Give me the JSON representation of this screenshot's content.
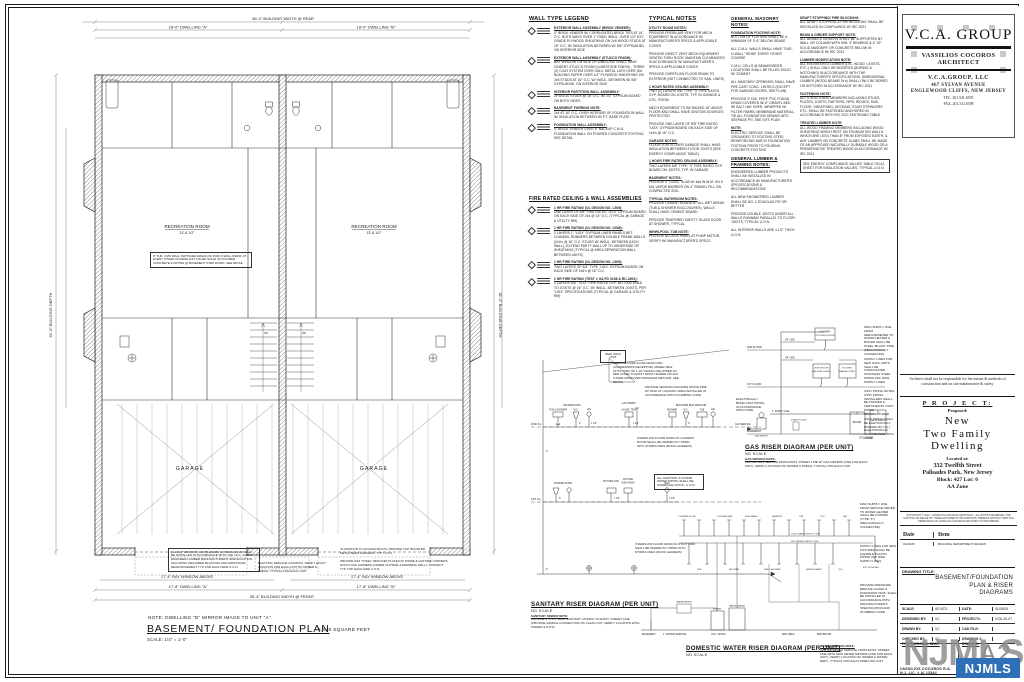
{
  "plan": {
    "note_mirror": "NOTE: DWELLING \"B\" MIRROR  IMAGE TO UNIT \"A\".",
    "title": "BASEMENT/ FOUNDATION PLAN",
    "scale": "SCALE: 1/4\" = 1'-0\"",
    "area": "2,049 SQUARE FEET",
    "rooms": {
      "recreation_a": "RECREATION ROOM",
      "recreation_a_dim": "13'-8 1/2\"",
      "recreation_b": "RECREATION ROOM",
      "recreation_b_dim": "13'-8 1/2\"",
      "garage_a": "GARAGE",
      "garage_b": "GARAGE",
      "up_a": "UP",
      "up_b": "UP"
    },
    "dims": {
      "top_total": "36'-0\" BUILDING WIDTH @ REAR",
      "top_a": "18'-0\" DWELLING \"A\"",
      "top_b": "18'-0\" DWELLING \"B\"",
      "bottom_bay_a": "17'-4\" BAY WINDOW ABOVE",
      "bottom_bay_b": "17'-4\" BAY WINDOW ABOVE",
      "bottom_a": "17'-8\" DWELLING \"A\"",
      "bottom_b": "17'-8\" DWELLING \"B\"",
      "bottom_total": "35'-4\" BUILDING WIDTH @ FRONT",
      "left_depth": "61'-0\" BUILDING DEPTH",
      "right_depth": "61'-0\" BUILDING DEPTH"
    },
    "notes": {
      "cmu": "8\" THK. CMU WALL SWITCHED AREAS W/ DUR-O-WALL REINF. AT EVERY OTHER COURSE (16\") FILLED SOLID ON POURED CONCRETE FOOTING @ BASEMENT STEP DOWN, SEE DETAIL",
      "bay": "ALL BAY WINDOW, CANTILEVERS & OVERHANGS SHALL BE INSTALLED IN ACCORDANCE WITH THE I.R.C. 2021 & ENGINEER LUMBER MANUFACTURER'S SPECIFICATION, INCLUDING REQUIRED BLOCKING AND ADDITIONAL REINFORCEMENT TYP. FOR EACH SIDE U.O.N.",
      "anchor": "IN ADDITION TO ANCHOR BOLTS, PROVIDE TOP MOUNTED METAL BEAM HANGERS, TYP. U.O.N.",
      "bracket": "PROVIDE 5/16 \"STEEL\" BRACKET PLATES AT INSIDE & OUTSIDE CORNERS NON FLUSH GIRDERS (UNDER OUTSIDE & DEMISING WALL), CONNECT TYP. TOP EACH SIDE U.O.N.",
      "electric": "ELECTRIC SERVICE LOCATION, VERIFY EXACT LOCATION FOR EACH UNIT W/ OWNER & PSE&G, TYPICAL FOR EACH UNIT"
    }
  },
  "legend_walls": {
    "title": "WALL TYPE LEGEND",
    "items": [
      {
        "h": "EXTERIOR WALL ASSEMBLY (BRICK VENEER):",
        "t": "4\" BRICK VENEER W/ CORRUGATED BRICK TIES AT 16\" O.C. BOTH WAYS OVER 1\" RIGID INSUL. OVER 1/2\" EXT. GRADE PLYWOOD SHEATHING ON 2x6 WOOD STUDS AT 16\" O.C. W/ INSULATION BETWEEN W/ 5/8\" GYPSUM BD. ON INTERIOR SIDE"
      },
      {
        "h": "EXTERIOR WALL ASSEMBLY (STUCCO FINISH):",
        "t": "BAY WINDOW ON SIDE OF DWELLING SHALL HAVE CEMENT STUCCO FINISH (LIMESTONE FINISH) - THREE (3) COAT SYSTEM OVER GALV. METAL LATH OVER 30# BUILDING PAPER OVER 1/2\" PLYWOOD SHEATHING ON 2x6 STUDS AT 16\" O.C. W/ INSUL. BETWEEN W/ 5/8\" GYPSUM BD. ON INTERIOR SIDE"
      },
      {
        "h": "INTERIOR PARTITION WALL ASSEMBLY:",
        "t": "2x WOOD STUDS @ 16\" O.C. W/ 1/2\" GYPSUM BOARD ON BOTH SIDES"
      },
      {
        "h": "BASEMENT FURRING NOTE:",
        "t": "2x4 AT 16\" O.C. OVER INTERIOR OF FOUNDATION WALL W/ INSULATION BETWEEN W/ P.T. BASE PLATE"
      },
      {
        "h": "FOUNDATION WALL ASSEMBLY:",
        "t": "4\" BRICK VENEER OVER 8\" BACKUP C.M.U. FOUNDATION WALL ON POURED CONCRETE FOOTING, SEE DETAIL"
      }
    ]
  },
  "legend_fire": {
    "title": "FIRE RATED CEILING & WALL ASSEMBLIES",
    "items": [
      {
        "h": "1 HR FIRE RATING (UL DESIGN NO. L505):",
        "t": "ONE LAYER OF 5/8\" FIRE RATED \"UGX\" GYPSUM BOARD ON EACH SIDE OF 2x4 @ 16\" O.C. (TYPICAL @ GARAGE & UTILITY RM)"
      },
      {
        "h": "1 HR FIRE RATING (UL DESIGN NO. U336):",
        "t": "2 LAYERS 1\" \"UGX\" GYPSUM LINER PANELS BET. CHANNEL RUNNERS BETWEEN DOUBLE FRAME WALLS (2x4's @ 16\" O.C. STUDS W/ INSUL. BETWEEN EACH WALL), EXTEND PARTY WALL UP TO UNDERSIDE OF SHEATHING (TYPICAL @ AREA SEPARATION WALL BETWEEN UNITS)"
      },
      {
        "h": "1 HR FIRE RATING (UL DESIGN NO. L505):",
        "t": "TWO LAYERS OF 5/8\" TYPE \"UGX\" GYPSUM BOARD ON EACH SIDE OF 2x4's @ 16\" O.C."
      },
      {
        "h": "1 HR FIRE RATING (TEST # GA FD 0108 & RC-2601):",
        "t": "2 LAYERS 5/8\" \"UGX\" FIRE RATED GYP. BD. FASTENED TO JOISTS @ 16\" O.C. W/ INSUL. BETWEEN JOISTS, PER \"UGX\" SPECIFICATIONS (TYPICAL @ GARAGE & UTILITY RM)"
      }
    ]
  },
  "notes_typical": {
    "title": "TYPICAL NOTES",
    "items": [
      {
        "h": "UTILITY ROOM NOTES:",
        "t": "PROVIDE FRESH-AIR VENT FOR MECH EQUIPMENT IN ACCORDANCE W/ MANUFACTURER'S SPECS & APPLICABLE CODES"
      },
      {
        "t": "PROVIDE DIRECT VENT MECH EQUIPMENT VENTED THRU ROOF, MAINTAIN CLEARANCES IN ACCORDANCE W/ MANUFACTURER'S SPECS & APPLICABLE CODES"
      },
      {
        "t": "PROVIDE OVERFLOW FLOOR DRAIN TO EXTERIOR (NOT CONNECTED TO SAN. LINES)"
      },
      {
        "h": "1 HOUR RATED CEILING ASSEMBLY:",
        "t": "TWO (2) LAYERS 5/8\" TYPE \"X\" FIRE RATED GYP. BOARD ON JOISTS, TYP. IN GARAGE & UTIL. ROOM"
      },
      {
        "t": "MECH EQUIPMENT TO BE RAISED 18\" ABOVE FLOOR AND SHALL HAVE IGNITION SOURCES PROTECTED"
      },
      {
        "t": "PROVIDE ONE LAYER OF 5/8\" FIRE RATED \"UGX\" GYPSUM BOARD ON EACH SIDE OF 2x4's @ 16\" O.C."
      },
      {
        "h": "GARAGE NOTES:",
        "t": "FLOOR JOISTS OVER GARAGE SHALL HAVE INSULATION BETWEEN FLOOR JOISTS (SEE ENERGY COMPLIANCE TABLE)"
      },
      {
        "h": "1 HOUR FIRE RATED CEILING ASSEMBLY:",
        "t": "TWO LAYERS 5/8\" TYPE \"X\" FIRE RATED GYP. BOARD ON JOISTS, TYP. IN GARAGE"
      },
      {
        "h": "BASEMENT NOTES:",
        "t": "PROVIDE 4\" CONC. SLAB W/ 6x6 W.W.M. ON 6 MIL VAPOR BARRIER ON 4\" GRAVEL FILL ON COMPACTED SOIL"
      },
      {
        "h": "TYPICAL BATHROOM NOTES:",
        "t": "PROVIDE CEMENT BOARD AT ALL WET AREAS (TUB & SHOWER ENCLOSURES), WALLS SHALL HAVE CEMENT BOARD"
      },
      {
        "t": "PROVIDE TEMPERED SAFETY GLASS DOOR AT SHOWER, TYPICAL"
      },
      {
        "h": "WHIRLPOOL TUB NOTE:",
        "t": "PROVIDE ACCESS PANEL AT PUMP MOTOR, VERIFY W/ MANUFACTURER'S SPECS"
      }
    ]
  },
  "notes_masonry": {
    "title": "GENERAL MASONRY NOTES:",
    "items": [
      {
        "h": "FOUNDATION FOOTING NOTE:",
        "t": "BOTTOM OF FOOTING SHALL BE A MINIMUM OF 3'-6\" BELOW GRADE"
      },
      {
        "t": "ALL C.M.U. WALLS SHALL HAVE \"DUR-O-WALL\" REINF. EVERY OTHER COURSE"
      },
      {
        "t": "C.M.U. CELLS @ BEAM/GIRDER LOCATIONS SHALL BE FILLED SOLID W/ CEMENT"
      },
      {
        "t": "ALL MASONRY OPENINGS SHALL HAVE PRE-CAST CONC. LINTELS (EXCEPT FOR GARAGE DOORS, SEE PLAN)"
      },
      {
        "t": "PROVIDE 4\" DIA. PERF. PVC FOUND. DRAIN COVERED W/ 6\" GRAVEL BED W/ SALT HAY OVER, WRAPPED W/ FILTER FABRIC MEMBRANE MATERIAL, TIE ALL FOUNDATION DRAINS INTO SEEPAGE PIT, SEE SITE PLAN"
      },
      {
        "h": "NOTE:",
        "t": "ELECTRIC SERVICE SHALL BE GROUNDED TO FOOTING STEEL REINFORCING BAR IN FOUNDATION FOOTING PRIOR TO POURING CONCRETE FOOTING"
      }
    ],
    "title2": "GENERAL LUMBER & FRAMING NOTES:",
    "items2": [
      {
        "t": "ENGINEERED LUMBER PRODUCTS SHALL BE INSTALLED IN ACCORDANCE W/ MANUFACTURER'S SPECIFICATIONS & RECOMMENDATIONS"
      },
      {
        "t": "ALL NEW ENGINEERED LUMBER SHALL BE NO. 1 DOUGLAS FIR OR BETTER"
      },
      {
        "t": "PROVIDE DOUBLE JOISTS UNDER ALL WALLS RUNNING PARALLEL TO FLOOR JOISTS, TYPICAL U.O.N."
      },
      {
        "t": "ALL INTERIOR WALLS ARE 4 1/2\" THICK U.O.N."
      }
    ]
  },
  "notes_right": {
    "items": [
      {
        "h": "DRAFT STOPPING/ FIRE BLOCKING:",
        "t": "ALL DRAFT STOPPING & FIRE BLOCKING SHALL BE INSTALLED IN COMPLIANCE W/ IRC 2021"
      },
      {
        "h": "BEAM & GIRDER SUPPORT NOTE:",
        "t": "ALL BEAMS & GIRDERS SHALL BE SUPPORTED BY WALL OR COLUMN WITH MIN. 3\" BEARING & 4\" OF SOLID MASONRY OR CONCRETE BELOW IN ACCORDANCE W/ IRC 2021"
      },
      {
        "h": "LUMBER MODIFICATION NOTE:",
        "t": "ALL ENGINEERED LUMBER (LVL, WOOD I JOISTS, ETC.) SHALL ONLY BE MODIFIED (BORING & NOTCHING) IN ACCORDANCE WITH THE MANUFACTURER'S SPECIFICATIONS. DIMENSIONAL LUMBER (WOOD BEAMS 2x's) SHALL ONLY BE BORED OR NOTCHED IN ACCORDANCE W/ IRC 2021"
      },
      {
        "h": "FASTENING NOTE:",
        "t": "ALL STRUCTURAL MEMBERS INCLUDING STUDS, PLATES, JOISTS, RAFTERS, HIPS, RIDGES, SUB-FLOOR, SHEATHING, DECKING, STAIR STRINGERS ETC. SHALL BE FASTENED/ ANCHORED IN ACCORDANCE WITH IRC 2021 FASTENING TABLE"
      },
      {
        "h": "TREATED LUMBER NOTE:",
        "t": "ALL WOOD FRAMING MEMBERS INCLUDING WOOD SHEATHING WHICH REST ON FOUNDATION WALLS, WHICH ARE LESS THAN 8\" FROM EXPOSED EARTH, & ANY LUMBER ON CONCRETE SLABS SHALL BE MADE OF AN APPROVED NATURALLY DURABLE WOOD OR A PRESERVATIVE TREATED WOOD IN ACCORDANCE W/ IRC 2021"
      },
      {
        "t": "SEE ENERGY COMPLIANCE VALUES TABLE ON A1 SHEET FOR INSULATION VALUES, TYPICAL U.O.N.",
        "box": true
      }
    ]
  },
  "risers": {
    "sanitary": {
      "title": "SANITARY RISER DIAGRAM (PER UNIT)",
      "scale": "NO SCALE",
      "note_h": "SANITARY SEWER NOTE:",
      "note": "PROVIDE 4\" P.V.C. MAIN SANITARY LATERAL TO EXIST. STREET LINE (PROVIDE SADDLE CONNECTION) W/ CLEAN OUT, VERIFY LOCATION WITH OWNER & D.P.W.",
      "labels": {
        "fl2": "2ND FL.",
        "fl1": "1ST FL.",
        "bathroom": "BATHROOM",
        "tub_shower": "TUB & SHOWER",
        "wc": "W.C.",
        "lav": "LAV",
        "laundry": "LAUNDRY",
        "laund_tray": "LAUND. TRAY",
        "master_bathroom": "MASTER BATHROOM",
        "shower": "SHOWER",
        "tub": "TUB",
        "powder_room": "POWDER ROOM",
        "kitchen_sink": "KITCHEN SINK",
        "kitchen": "KITCHEN",
        "dish_wash": "DISH WASH",
        "bar": "BAR",
        "hvac": "NEW HVAC UNIT"
      },
      "notes": {
        "overflow_attic": "PROVIDE OVER-FLOW DRAIN PAN (CONDENSATE RECEPTOR) UNDER NEW ATTIC HVAC W/ 1 1/4\" DRAIN LINE (PIPED AS PER CODE) TO EXIST ROOF LEADER OR ANY OTHER APPROVED DRAINAGE METHOD, SEE DETAIL",
        "washing_machine": "PROVIDE WASHING MACHINE STAND PIPE W/ TRAP AT LAUNDRY AREA INSTALLED IN ACCORDANCE WITH PLUMBING CODE",
        "overflow_laundry": "OVERFLOW FLOOR DRAIN IN LAUNDRY ROOM SHALL BE INDIRECTLY PIPED INTO STORM LINES (ROOF LEADERS)",
        "overflow_utility": "OVERFLOW FLOOR DRAIN IN UTILITY RM SHALL BE INDIRECTLY PIPED INTO STORM LINES (ROOF LEADERS)",
        "boxed": "ALL SANITARY & STORM WATER PIPING SHALL BE SCHEDULE 40 PVC, U.O.N."
      }
    },
    "gas": {
      "title": "GAS RISER DIAGRAM (PER UNIT)",
      "scale": "NO SCALE",
      "note_h": "GAS SERVICE NOTE:",
      "note": "INSTALL GAS SERVICE FROM EXIST. STREET LINE W/ GAS METERS (ONE FOR EACH UNIT), VERIFY LOCATION W/ OWNER & PSE&G, TYPICAL FOR EACH UNIT",
      "labels": {
        "fl2": "2ND FLOOR",
        "fl1": "1ST FLOOR",
        "bsmt": "BASEMENT",
        "laundry": "LAUNDRY",
        "dryer": "CLOTHES DRYER",
        "living": "LIVING ROOM",
        "fireplace": "GAS FIRE PLACE",
        "kitchen": "KITCHEN",
        "range": "RANGE/ OVEN",
        "boiler": "BOILER",
        "heater": "WATER HEATER",
        "meter": "GAS METER",
        "service": "GAS SERVICE",
        "util": "UTIL. ROOM",
        "supply1": "1\" SUPPLY LINE",
        "line34": "3/4\" LINE",
        "pocket": "SCALE POCKET"
      },
      "notes": {
        "main_supply": "MAIN SUPPLY LINE FROM SERVICE/METER TO WATER HEATER & BOILER SHALL BE STEEL \"BLACK\" PIPE (MECHANICALLY CONNECTED)",
        "supply_hvac": "SUPPLY LINES FOR NEW HVAC UNITS SHALL BE CORRUGATED STAINLESS STEEL PIPING OFF MAIN SUPPLY LINES",
        "csst1": "CSST PIPING NOTES: CSST PIPING INSTALLERS SHALL BE TRAINED & CERTIFIED BY CSST PIPING MANUFACTURER",
        "csst2": "CSST PIPING SHALL BE ELECTRICALLY BONDED (BY LIC.) ELECTRICIAN IN ACCORDANCE WITH CODE",
        "bond": "ELECTRICALLY BOND CSST PIPING IN ACCORDANCE WITH CODE"
      }
    },
    "water": {
      "title": "DOMESTIC WATER RISER DIAGRAM (PER UNIT)",
      "scale": "NO SCALE",
      "note_h": "WATER SERVICE NOTE:",
      "note": "INSTALL WATER SERVICE FROM EXIST. STREET LINE WITH NEW WATER METERS (ONE FOR EACH UNIT), VERIFY LOCATION W/ OWNER & WATER DEPT., TYPICAL FOR EACH DWELLING UNIT",
      "labels": {
        "bsmt": "BASEMENT",
        "service": "1\" WATER SERVICE",
        "meter": "WATER METER",
        "boiler": "BOILER",
        "heater": "WATER HEATER",
        "util": "UTIL. ROOM",
        "bar": "BAR AREA",
        "bathroom": "BATHROOM",
        "powder": "POWDER ROOM",
        "kitchen_sink": "KITCHEN SINK",
        "dish_wash": "DISH WASH",
        "laundry": "LAUNDRY",
        "master_bath": "MASTER BATH",
        "tub_shower": "TUB & SHOWER",
        "tub": "TUB",
        "wc": "W.C.",
        "lav": "LAV",
        "shower": "SHOWER",
        "hose_bib": "EXT. HOSE BIB",
        "cold": "COLD WATER SUPPLY LINE",
        "hot": "HOT WATER SUPPLY LINE"
      },
      "notes": {
        "main_supply": "MAIN SUPPLY LINE FROM SERVICE/ METER TO WATER HEATER SHALL BE COPPER (TYPE \"K\") (MECHANICALLY CONNECTED)",
        "supply_fixtures": "SUPPLY LINES FOR NEW FIXTURES SHALL BE FLEXIBLE PLASTIC PIPING OFF MAIN SUPPLY LINES",
        "pressure": "PROVIDE PRESSURE REDUCE GAUGE & EXPANSION TANK, SHALL BE INSTALLED IN ACCORDANCE WITH MANUFACTURER'S SPECIFICATION AND PLUMBING CODE"
      }
    },
    "sizes": {
      "s4": "4\"",
      "s3": "3\"",
      "s2": "2\"",
      "s112": "1 1/2\"",
      "s114": "1 1/4\"",
      "s34": "3/4\"",
      "s1": "1\""
    }
  },
  "title_block": {
    "logo": {
      "name": "V.C.A. GROUP",
      "subtitle": "VASSILIOS COCOROS ARCHITECT",
      "firm": "V.C.A.GROUP,  LLC",
      "address1": "467 SYLVAN AVENUE",
      "address2": "ENGLEWOOD CLIFFS, NEW JERSEY",
      "tel": "TEL. 201.541.6595",
      "fax": "FAX. 201.541.6598"
    },
    "disclaimer": "Architect shall not be responsible for the means & methods of construction and on site maintenance & safety",
    "project": {
      "heading": "P R O J E C T:",
      "proposed": "Proposed:",
      "name_line1": "New",
      "name_line2": "Two  Family",
      "name_line3": "Dwelling",
      "located": "Located  at:",
      "address": "332 Twelfth Street",
      "city": "Palisades Park, New Jersey",
      "block_lot": "Block: 427 Lot: 6",
      "zone": "AA Zone"
    },
    "copyright": "COPYRIGHT © 2021 - VASSILIOS COCOROS ARCHITECT - ALL RIGHTS RESERVED. THE COPYING OR REUSE OF THESE DOCUMENTS OR PORTIONS THEREOF WITHOUT WRITTEN PERMISSION OF VASSILIOS COCOROS ARCHITECT IS PROHIBITED",
    "revisions": {
      "date_header": "Date",
      "item_header": "Item",
      "row_date": "01/06/25",
      "row_item": "BUILDING DEPARTMENT REVIEW"
    },
    "drawing_title_label": "DRAWING TITLE:",
    "drawing_title": "BASEMENT/FOUNDATION PLAN & RISER DIAGRAMS",
    "fields": {
      "scale_label": "SCALE:",
      "scale": "AS NTD",
      "date_label": "DATE:",
      "date": "01/06/25",
      "designed_label": "DESIGNED BY:",
      "designed": "VC",
      "project_no_label": "PROJECT#:",
      "project_no": "VGA-25-07",
      "drawn_label": "DRAWN BY:",
      "drawn": "VC",
      "cad_label": "CAD FILE:",
      "cad": "",
      "checked_label": "CHECKED BY:",
      "checked": "VC",
      "drawing_no_label": "DRAWING #:",
      "drawing_no": "",
      "seal_label": "PROFESSIONAL SEAL:",
      "drawing_label": "DRAWING:",
      "sheet_no": "A2"
    },
    "architect_name": "VASSILIOS COCOROS R.A.",
    "license": "N.J. LIC. # AI 13544"
  },
  "watermark": {
    "text": "NJMLS",
    "badge": "NJMLS",
    "badge_color": "#2e6fb7"
  }
}
